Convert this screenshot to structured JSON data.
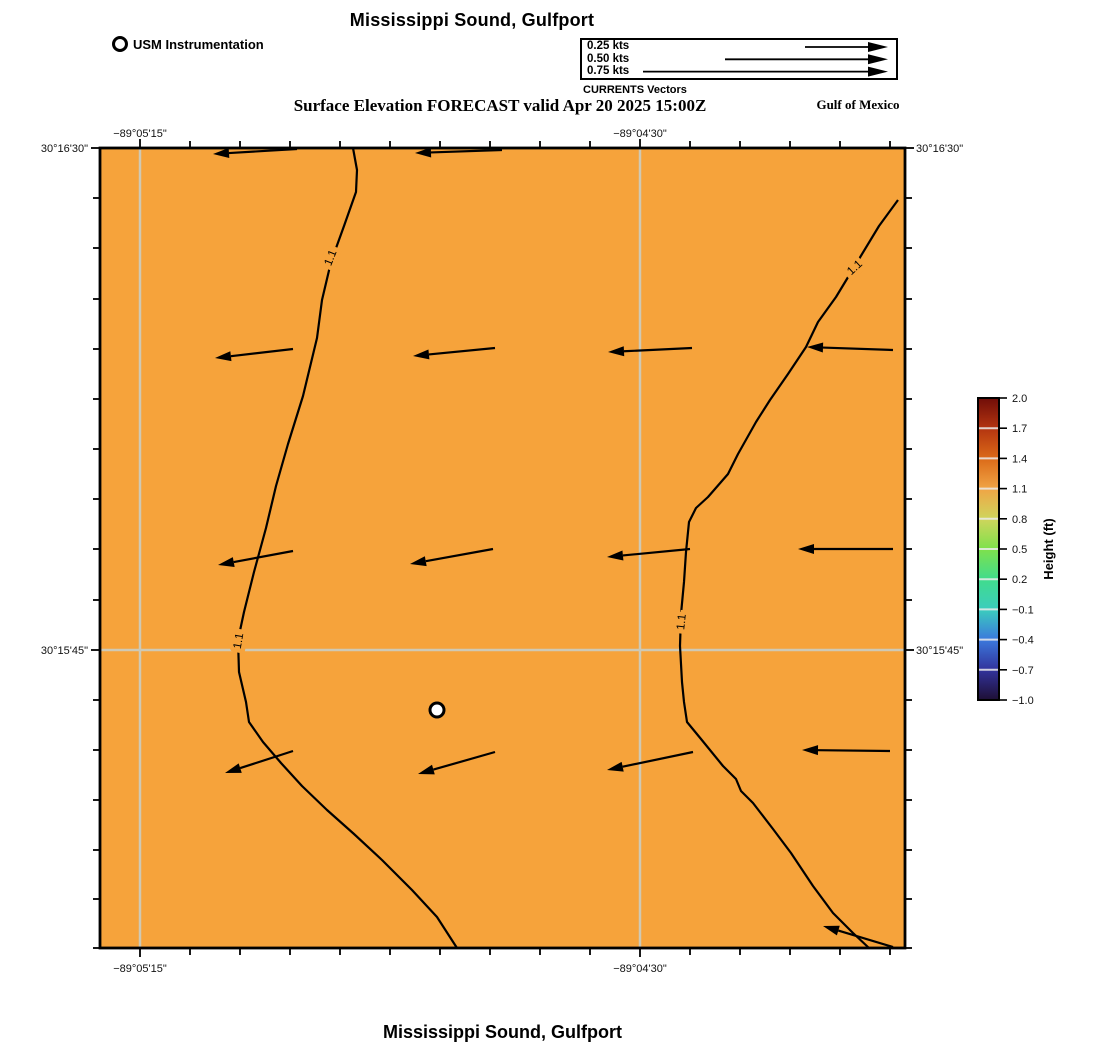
{
  "title_top": "Mississippi Sound, Gulfport",
  "title_bottom": "Mississippi Sound, Gulfport",
  "subtitle": "Surface Elevation FORECAST valid Apr 20 2025 15:00Z",
  "region_label": "Gulf of Mexico",
  "instrumentation_legend": {
    "label": "USM Instrumentation",
    "marker": "white-circle-marker"
  },
  "vector_legend": {
    "caption": "CURRENTS Vectors",
    "rows": [
      {
        "label": "0.25 kts",
        "length_px": 83
      },
      {
        "label": "0.50 kts",
        "length_px": 163
      },
      {
        "label": "0.75 kts",
        "length_px": 245
      }
    ]
  },
  "axes": {
    "top": [
      {
        "text": "−89°05'15\"",
        "x": 140
      },
      {
        "text": "−89°04'30\"",
        "x": 640
      }
    ],
    "bottom": [
      {
        "text": "−89°05'15\"",
        "x": 140
      },
      {
        "text": "−89°04'30\"",
        "x": 640
      }
    ],
    "left": [
      {
        "text": "30°16'30\"",
        "y": 148
      },
      {
        "text": "30°15'45\"",
        "y": 650
      }
    ],
    "right": [
      {
        "text": "30°16'30\"",
        "y": 148
      },
      {
        "text": "30°15'45\"",
        "y": 650
      }
    ]
  },
  "colorbar": {
    "label": "Height (ft)",
    "ticks": [
      "2.0",
      "1.7",
      "1.4",
      "1.1",
      "0.8",
      "0.5",
      "0.2",
      "−0.1",
      "−0.4",
      "−0.7",
      "−1.0"
    ],
    "stops": [
      {
        "offset": "0%",
        "color": "#700D08"
      },
      {
        "offset": "10%",
        "color": "#B33410"
      },
      {
        "offset": "20%",
        "color": "#DB6A18"
      },
      {
        "offset": "30%",
        "color": "#F0A445"
      },
      {
        "offset": "40%",
        "color": "#CFD55C"
      },
      {
        "offset": "50%",
        "color": "#7FE14C"
      },
      {
        "offset": "60%",
        "color": "#41DC8C"
      },
      {
        "offset": "70%",
        "color": "#3BCDBD"
      },
      {
        "offset": "80%",
        "color": "#3B79DC"
      },
      {
        "offset": "90%",
        "color": "#32339C"
      },
      {
        "offset": "100%",
        "color": "#1E0F35"
      }
    ]
  },
  "colors": {
    "sea": "#F6A33B",
    "grid": "#CFC9B4",
    "contour": "#000000",
    "frame": "#000000"
  },
  "map": {
    "frame": {
      "x": 100,
      "y": 148,
      "w": 805,
      "h": 800
    },
    "grid_x": [
      140,
      640
    ],
    "grid_y": [
      650
    ],
    "ticks_x": [
      140,
      190,
      240,
      290,
      340,
      390,
      440,
      490,
      540,
      590,
      640,
      690,
      740,
      790,
      840,
      890
    ],
    "ticks_y": [
      148,
      198,
      248,
      299,
      349,
      399,
      449,
      499,
      549,
      600,
      650,
      700,
      750,
      800,
      850,
      899,
      948
    ],
    "contours": [
      {
        "label": "1.1",
        "points": [
          [
            353,
            148
          ],
          [
            357,
            170
          ],
          [
            356,
            192
          ],
          [
            344,
            226
          ],
          [
            331,
            262
          ],
          [
            322,
            300
          ],
          [
            317,
            338
          ],
          [
            303,
            396
          ],
          [
            288,
            444
          ],
          [
            276,
            486
          ],
          [
            266,
            528
          ],
          [
            254,
            572
          ],
          [
            244,
            612
          ],
          [
            238,
            640
          ],
          [
            239,
            672
          ],
          [
            246,
            702
          ],
          [
            249,
            722
          ],
          [
            263,
            742
          ],
          [
            281,
            763
          ],
          [
            302,
            786
          ],
          [
            327,
            810
          ],
          [
            354,
            834
          ],
          [
            382,
            860
          ],
          [
            412,
            890
          ],
          [
            437,
            917
          ],
          [
            457,
            948
          ]
        ]
      },
      {
        "label": "1.1",
        "points": [
          [
            898,
            200
          ],
          [
            879,
            226
          ],
          [
            856,
            264
          ],
          [
            836,
            297
          ],
          [
            818,
            322
          ],
          [
            806,
            347
          ],
          [
            788,
            374
          ],
          [
            770,
            400
          ],
          [
            756,
            422
          ],
          [
            738,
            454
          ],
          [
            728,
            474
          ],
          [
            708,
            497
          ],
          [
            696,
            508
          ],
          [
            689,
            522
          ],
          [
            686,
            552
          ],
          [
            684,
            582
          ],
          [
            681,
            614
          ],
          [
            680,
            646
          ],
          [
            682,
            682
          ],
          [
            684,
            702
          ],
          [
            687,
            722
          ],
          [
            701,
            739
          ],
          [
            723,
            766
          ],
          [
            736,
            779
          ],
          [
            741,
            791
          ],
          [
            753,
            803
          ],
          [
            773,
            829
          ],
          [
            791,
            853
          ],
          [
            813,
            886
          ],
          [
            833,
            913
          ],
          [
            853,
            933
          ],
          [
            869,
            948
          ]
        ]
      }
    ],
    "contour_labels": [
      {
        "text": "1.1",
        "x": 331,
        "y": 258,
        "rot": -68
      },
      {
        "text": "1.1",
        "x": 239,
        "y": 641,
        "rot": -80
      },
      {
        "text": "1.1",
        "x": 855,
        "y": 268,
        "rot": -43
      },
      {
        "text": "1.1",
        "x": 682,
        "y": 622,
        "rot": -84
      }
    ],
    "arrows": [
      {
        "head": [
          213,
          154
        ],
        "tail": [
          297,
          149
        ]
      },
      {
        "head": [
          415,
          153
        ],
        "tail": [
          502,
          150
        ]
      },
      {
        "head": [
          215,
          358
        ],
        "tail": [
          293,
          349
        ]
      },
      {
        "head": [
          413,
          356
        ],
        "tail": [
          495,
          348
        ]
      },
      {
        "head": [
          608,
          352
        ],
        "tail": [
          692,
          348
        ]
      },
      {
        "head": [
          807,
          347
        ],
        "tail": [
          893,
          350
        ]
      },
      {
        "head": [
          218,
          565
        ],
        "tail": [
          293,
          551
        ]
      },
      {
        "head": [
          410,
          564
        ],
        "tail": [
          493,
          549
        ]
      },
      {
        "head": [
          607,
          557
        ],
        "tail": [
          690,
          549
        ]
      },
      {
        "head": [
          798,
          549
        ],
        "tail": [
          893,
          549
        ]
      },
      {
        "head": [
          225,
          773
        ],
        "tail": [
          293,
          751
        ]
      },
      {
        "head": [
          418,
          774
        ],
        "tail": [
          495,
          752
        ]
      },
      {
        "head": [
          607,
          770
        ],
        "tail": [
          693,
          752
        ]
      },
      {
        "head": [
          802,
          750
        ],
        "tail": [
          890,
          751
        ]
      },
      {
        "head": [
          823,
          926
        ],
        "tail": [
          893,
          947
        ]
      }
    ],
    "station_marker": {
      "x": 437,
      "y": 710,
      "r": 7
    },
    "colorbar_geom": {
      "x": 978,
      "y": 398,
      "w": 21,
      "h": 302,
      "label_x": 1053,
      "label_y": 549
    }
  },
  "chart_data": {
    "type": "heatmap",
    "title": "Mississippi Sound, Gulfport",
    "subtitle": "Surface Elevation FORECAST valid Apr 20 2025 15:00Z",
    "field": "surface elevation (ft)",
    "field_value_displayed_range": [
      1.1,
      1.3
    ],
    "contour_levels_shown": [
      1.1
    ],
    "x_axis": {
      "label": "longitude",
      "tick_labels": [
        "−89°05'15\"",
        "−89°04'30\""
      ]
    },
    "y_axis": {
      "label": "latitude",
      "tick_labels": [
        "30°16'30\"",
        "30°15'45\""
      ]
    },
    "colorbar": {
      "label": "Height (ft)",
      "min": -1.0,
      "max": 2.0,
      "tick_interval": 0.3,
      "tick_values": [
        2.0,
        1.7,
        1.4,
        1.1,
        0.8,
        0.5,
        0.2,
        -0.1,
        -0.4,
        -0.7,
        -1.0
      ]
    },
    "vectors": {
      "legend_speeds_kts": [
        0.25,
        0.5,
        0.75
      ],
      "direction": "westward (arrows point left)",
      "approx_field_speed_kts": 0.25
    },
    "annotations": [
      "USM Instrumentation",
      "Gulf of Mexico",
      "CURRENTS Vectors"
    ],
    "legend_position": "top-right box",
    "grid": true
  }
}
